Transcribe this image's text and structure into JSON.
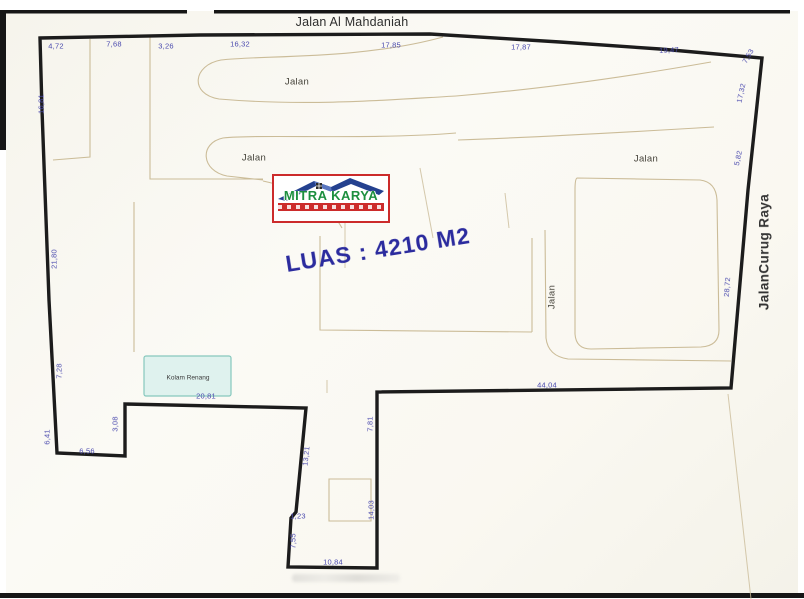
{
  "plan": {
    "top_road": "Jalan Al Mahdaniah",
    "right_road": "JalanCurug Raya",
    "area_text": "LUAS : 4210 M2",
    "pool_label": "Kolam Renang",
    "logo": {
      "brand": "MITRA KARYA"
    },
    "street_labels": [
      {
        "text": "Jalan",
        "x": 297,
        "y": 82,
        "rot": 0
      },
      {
        "text": "Jalan",
        "x": 254,
        "y": 158,
        "rot": 0
      },
      {
        "text": "Jalan",
        "x": 646,
        "y": 159,
        "rot": 0
      },
      {
        "text": "Jalan",
        "x": 552,
        "y": 297,
        "rot": -90
      }
    ],
    "dimensions": [
      {
        "v": "4,72",
        "x": 56,
        "y": 46,
        "rot": 0
      },
      {
        "v": "7,68",
        "x": 114,
        "y": 44,
        "rot": 0
      },
      {
        "v": "3,26",
        "x": 166,
        "y": 46,
        "rot": 0
      },
      {
        "v": "16,32",
        "x": 240,
        "y": 44,
        "rot": 0
      },
      {
        "v": "17,85",
        "x": 391,
        "y": 45,
        "rot": 0
      },
      {
        "v": "17,87",
        "x": 521,
        "y": 47,
        "rot": 0
      },
      {
        "v": "19,47",
        "x": 669,
        "y": 50,
        "rot": -3
      },
      {
        "v": "7,53",
        "x": 748,
        "y": 56,
        "rot": -60
      },
      {
        "v": "17,32",
        "x": 741,
        "y": 93,
        "rot": -78
      },
      {
        "v": "5,82",
        "x": 738,
        "y": 158,
        "rot": -78
      },
      {
        "v": "28,72",
        "x": 727,
        "y": 287,
        "rot": -86
      },
      {
        "v": "16,81",
        "x": 41,
        "y": 104,
        "rot": -90
      },
      {
        "v": "21,80",
        "x": 54,
        "y": 259,
        "rot": -90
      },
      {
        "v": "7,28",
        "x": 59,
        "y": 371,
        "rot": -90
      },
      {
        "v": "6,41",
        "x": 47,
        "y": 437,
        "rot": -90
      },
      {
        "v": "6,56",
        "x": 87,
        "y": 451,
        "rot": 0
      },
      {
        "v": "3,08",
        "x": 115,
        "y": 424,
        "rot": -90
      },
      {
        "v": "20,81",
        "x": 206,
        "y": 396,
        "rot": 0
      },
      {
        "v": "13,21",
        "x": 306,
        "y": 456,
        "rot": -84
      },
      {
        "v": "1,23",
        "x": 298,
        "y": 516,
        "rot": 0
      },
      {
        "v": "7,55",
        "x": 293,
        "y": 541,
        "rot": -90
      },
      {
        "v": "10,84",
        "x": 333,
        "y": 562,
        "rot": 0
      },
      {
        "v": "14,03",
        "x": 371,
        "y": 510,
        "rot": -90
      },
      {
        "v": "7,81",
        "x": 370,
        "y": 424,
        "rot": -90
      },
      {
        "v": "44,04",
        "x": 547,
        "y": 385,
        "rot": 0
      }
    ],
    "colors": {
      "boundary": "#1c1c1c",
      "parcel_line": "#cbbc98",
      "dimension_text": "#4a4aae",
      "area_text": "#2b2b9e",
      "logo_red": "#cc2b2b",
      "logo_blue": "#24418f",
      "logo_green": "#1d8f3f",
      "pool_fill": "#dff2ee",
      "pool_border": "#86c8bd",
      "paper": "#faf8f2"
    }
  }
}
